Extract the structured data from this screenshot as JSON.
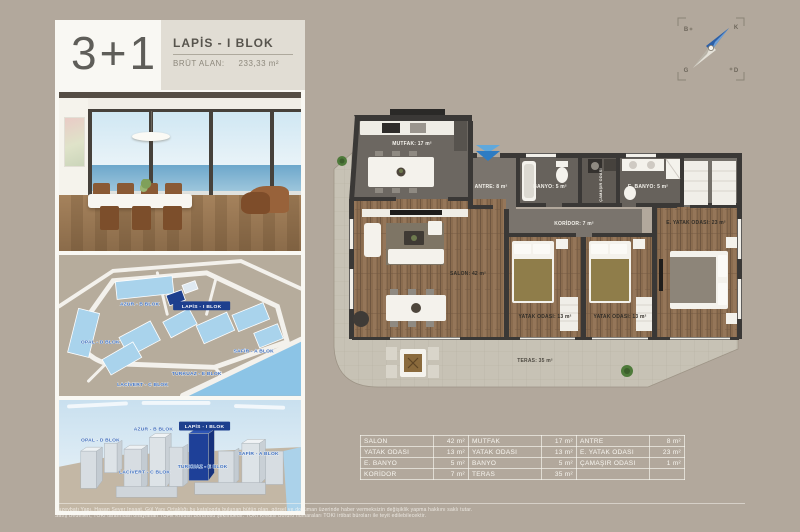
{
  "page": {
    "background": "#b2a89c"
  },
  "colors": {
    "accent_blue": "#1d3f8e",
    "map_building_blue": "#a9d3ec",
    "entrance_arrow_blue": "#2e7cc3",
    "panel_white": "#f9f8f3"
  },
  "header": {
    "unit_type": "3+1",
    "block_name": "LAPİS - I BLOK",
    "gross_area_label": "BRÜT ALAN:",
    "gross_area_value": "233,33 m²"
  },
  "compass": {
    "north": "K",
    "south": "G",
    "east": "D",
    "west": "B"
  },
  "plan": {
    "mutfak": "MUTFAK: 17 m²",
    "antre": "ANTRE: 8 m²",
    "banyo": "BANYO: 5 m²",
    "camasir": "ÇAMAŞIR ODASI",
    "e_banyo": "E. BANYO: 5 m²",
    "koridor": "KORİDOR: 7 m²",
    "e_yatak": "E. YATAK ODASI: 23 m²",
    "salon": "SALON: 42 m²",
    "yatak1": "YATAK ODASI: 13 m²",
    "yatak2": "YATAK ODASI: 13 m²",
    "teras": "TERAS: 35 m²"
  },
  "blocks": {
    "opal": "OPAL - D BLOK",
    "azur": "AZUR - B BLOK",
    "lapis": "LAPİS - I BLOK",
    "safir": "SAFİR - A BLOK",
    "turkuaz": "TURKUAZ - E BLOK",
    "lacivert": "LACİVERT - C BLOK"
  },
  "area_table": {
    "rows": [
      [
        "SALON",
        "42 m²",
        "MUTFAK",
        "17 m²",
        "ANTRE",
        "8 m²"
      ],
      [
        "YATAK ODASI",
        "13 m²",
        "YATAK ODASI",
        "13 m²",
        "E. YATAK ODASI",
        "23 m²"
      ],
      [
        "E. BANYO",
        "5 m²",
        "BANYO",
        "5 m²",
        "ÇAMAŞIR ODASI",
        "1 m²"
      ],
      [
        "KORİDOR",
        "7 m²",
        "TERAS",
        "35 m²",
        "",
        ""
      ]
    ]
  },
  "disclaimer": {
    "line1": "Kuzeybatı Yapı, Hasan Sever İnşaat, Gül Yapı Ortaklığı bu katalogda bulunan bütün plan, görsel ve doküman üzerinde haber vermeksizin değişiklik yapma hakkını saklı tutar.",
    "line2": "Satış Bedelleri, TOKİ tarafından onaylanan TÜFE Kredisi Bordrosu şeklindedir. TOKİ Kredisi Bordro numaraları TOKİ irtibat büroları ile teyit edilebilecektir."
  }
}
